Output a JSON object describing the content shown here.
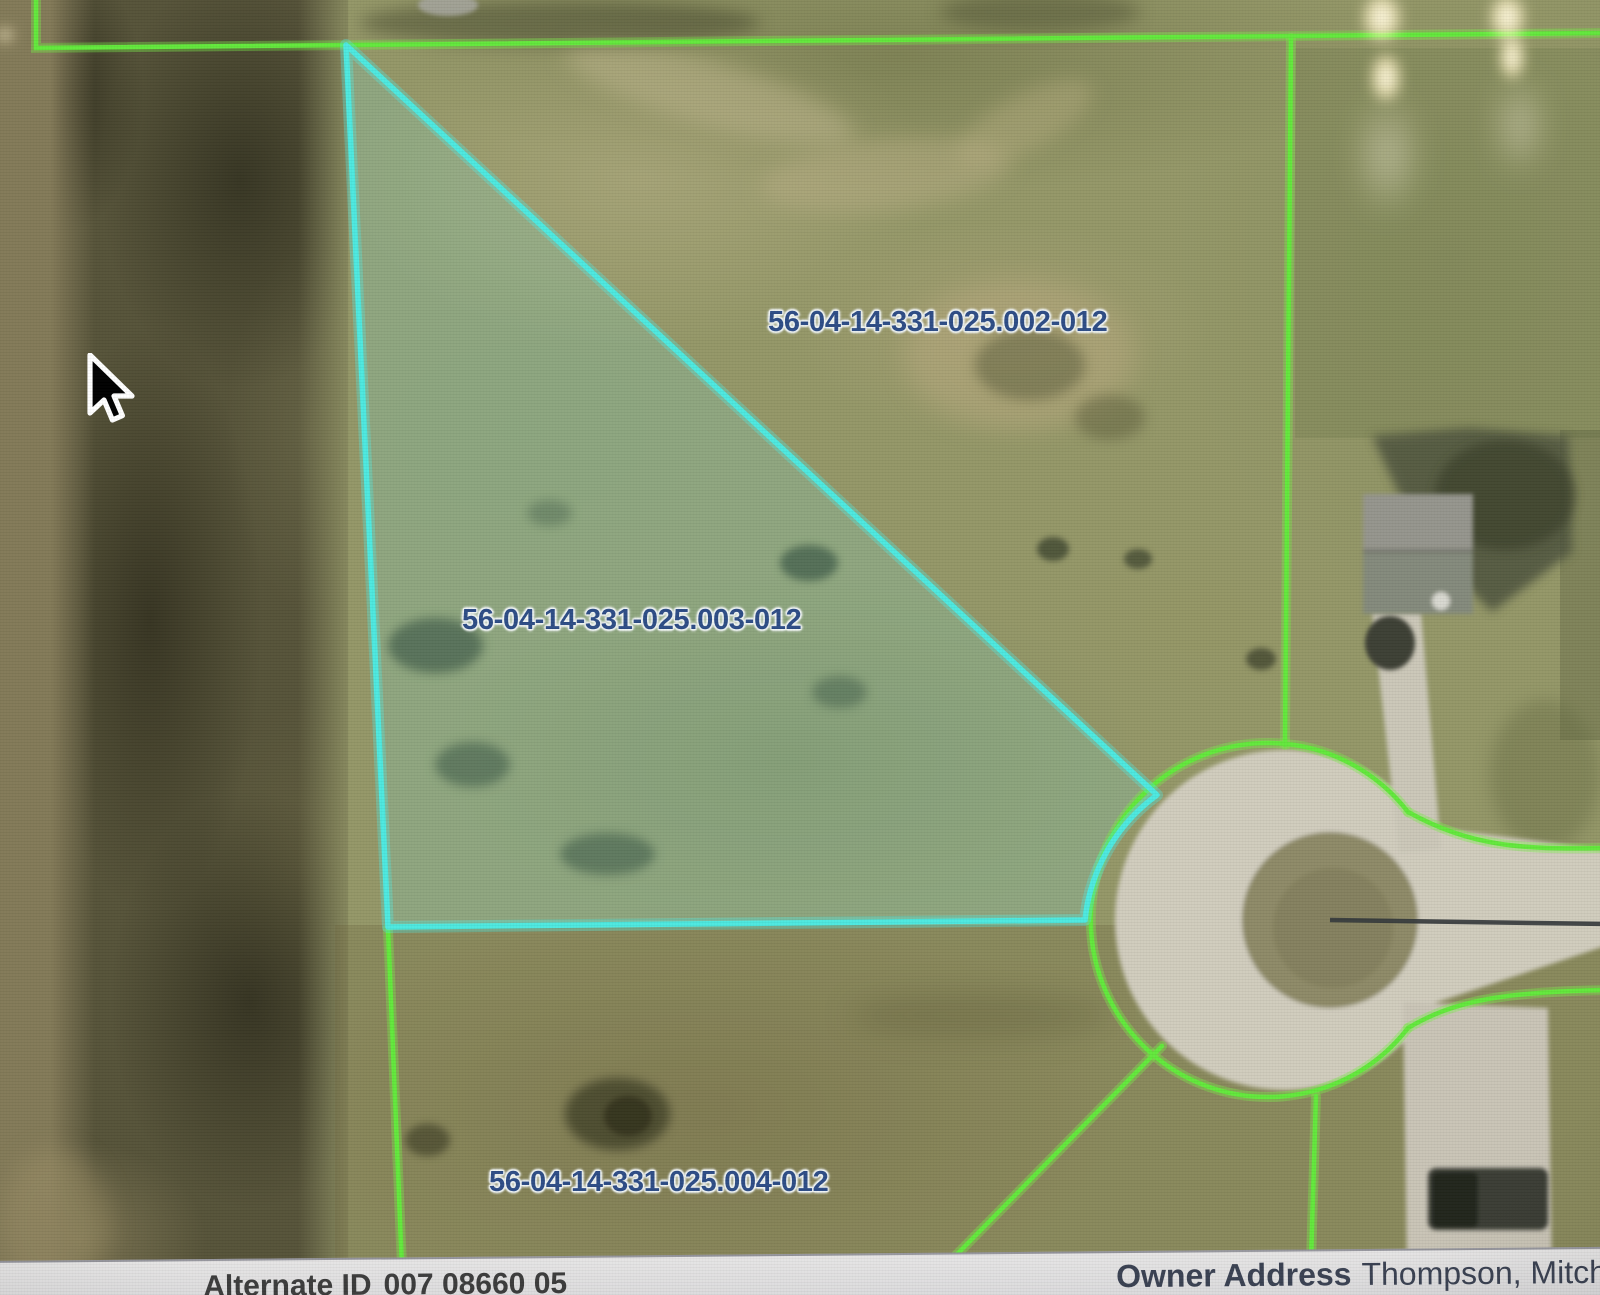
{
  "map": {
    "parcels": [
      {
        "label": "56-04-14-331-025.002-012",
        "selected": false
      },
      {
        "label": "56-04-14-331-025.003-012",
        "selected": true
      },
      {
        "label": "56-04-14-331-025.004-012",
        "selected": false
      }
    ],
    "features": {
      "road": "cul-de-sac with road stem to right edge",
      "selected_parcel_shape": "triangle"
    }
  },
  "footer": {
    "alternate_id": {
      "label": "Alternate ID",
      "value": "007 08660 05"
    },
    "owner": {
      "label": "Owner Address",
      "value": "Thompson, Mitchell"
    }
  },
  "colors": {
    "boundary_green": "#63e93c",
    "selected_cyan": "#4de9e0",
    "selected_fill": "rgba(125,232,220,0.20)",
    "label_blue": "#2e4d86",
    "pavement_gray": "#d0ccbd",
    "footer_bar": "#d9d9db"
  }
}
